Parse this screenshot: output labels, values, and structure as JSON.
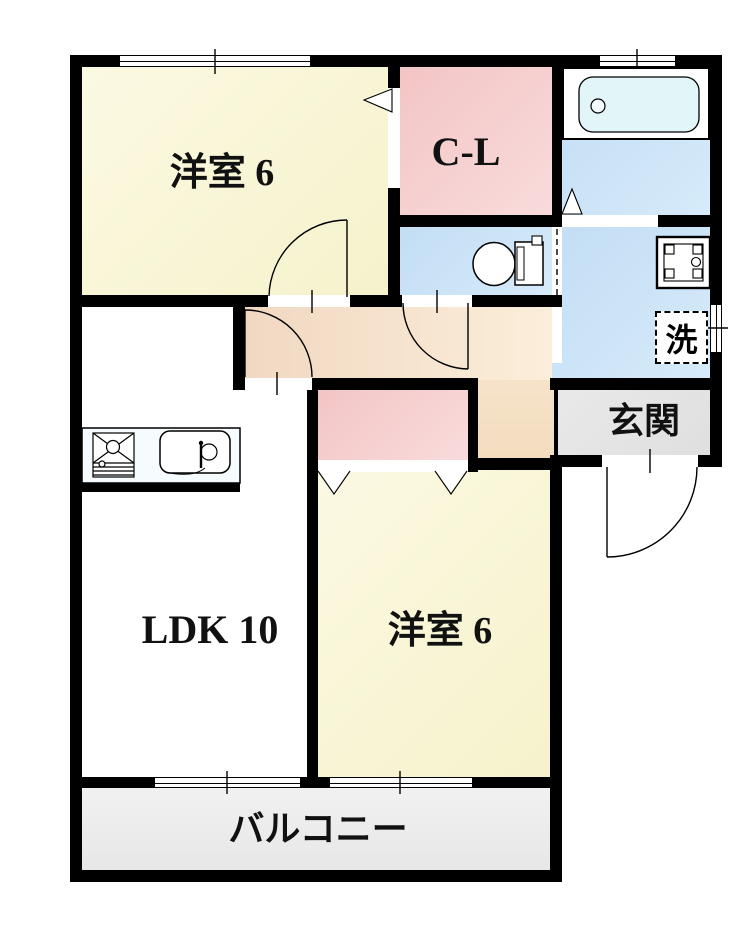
{
  "floorplan": {
    "rooms": {
      "bedroom_top": {
        "label": "洋室 6",
        "color": "#f8f5d5"
      },
      "closet_cl": {
        "label": "C-L",
        "color": "#f5c9c9"
      },
      "bathroom": {
        "color": "#c8e3f5"
      },
      "toilet": {
        "color": "#cde5f7"
      },
      "washroom": {
        "color": "#c9e2f6"
      },
      "laundry": {
        "label": "洗"
      },
      "entrance": {
        "label": "玄関",
        "color": "#e5e5e5"
      },
      "hallway": {
        "color": "#f6e0c6"
      },
      "ldk": {
        "label": "LDK 10",
        "color": "#ffffff"
      },
      "bedroom_bottom": {
        "label": "洋室 6",
        "color": "#f9f7d8"
      },
      "closet_bottom": {
        "color": "#f7caca"
      },
      "balcony": {
        "label": "バルコニー",
        "color": "#ededed"
      }
    },
    "wall_color": "#000000",
    "bathtub_fill": "#e2f6fa"
  }
}
